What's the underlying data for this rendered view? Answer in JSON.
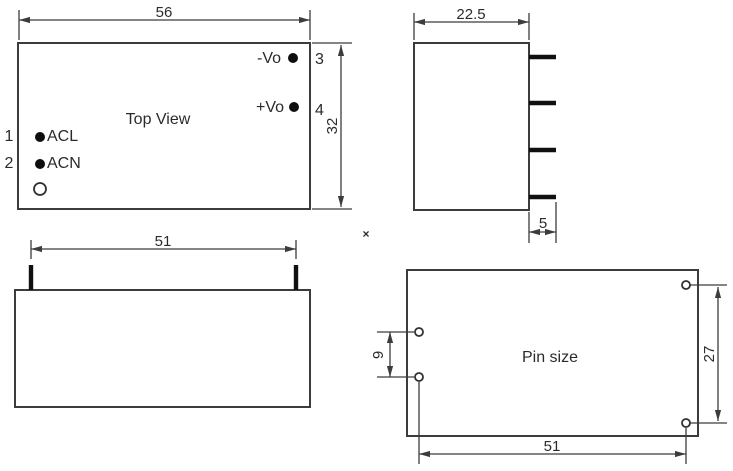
{
  "palette": {
    "background": "#ffffff",
    "line_color": "#3c3c3c",
    "pin_color": "#101010",
    "text_color": "#2b2b2b"
  },
  "top_view": {
    "title": "Top View",
    "width_dim": "56",
    "height_dim": "32",
    "pins": [
      {
        "num": "1",
        "label": "ACL"
      },
      {
        "num": "2",
        "label": "ACN"
      },
      {
        "num": "3",
        "label": "-Vo"
      },
      {
        "num": "4",
        "label": "+Vo"
      }
    ]
  },
  "side_view": {
    "width_dim": "22.5",
    "pin_length_dim": "5"
  },
  "front_view": {
    "pin_span_dim": "51"
  },
  "pin_size_view": {
    "title": "Pin size",
    "left_pin_pitch_dim": "9",
    "right_pin_pitch_dim": "27",
    "pin_span_dim": "51"
  },
  "stray_mark": "×"
}
